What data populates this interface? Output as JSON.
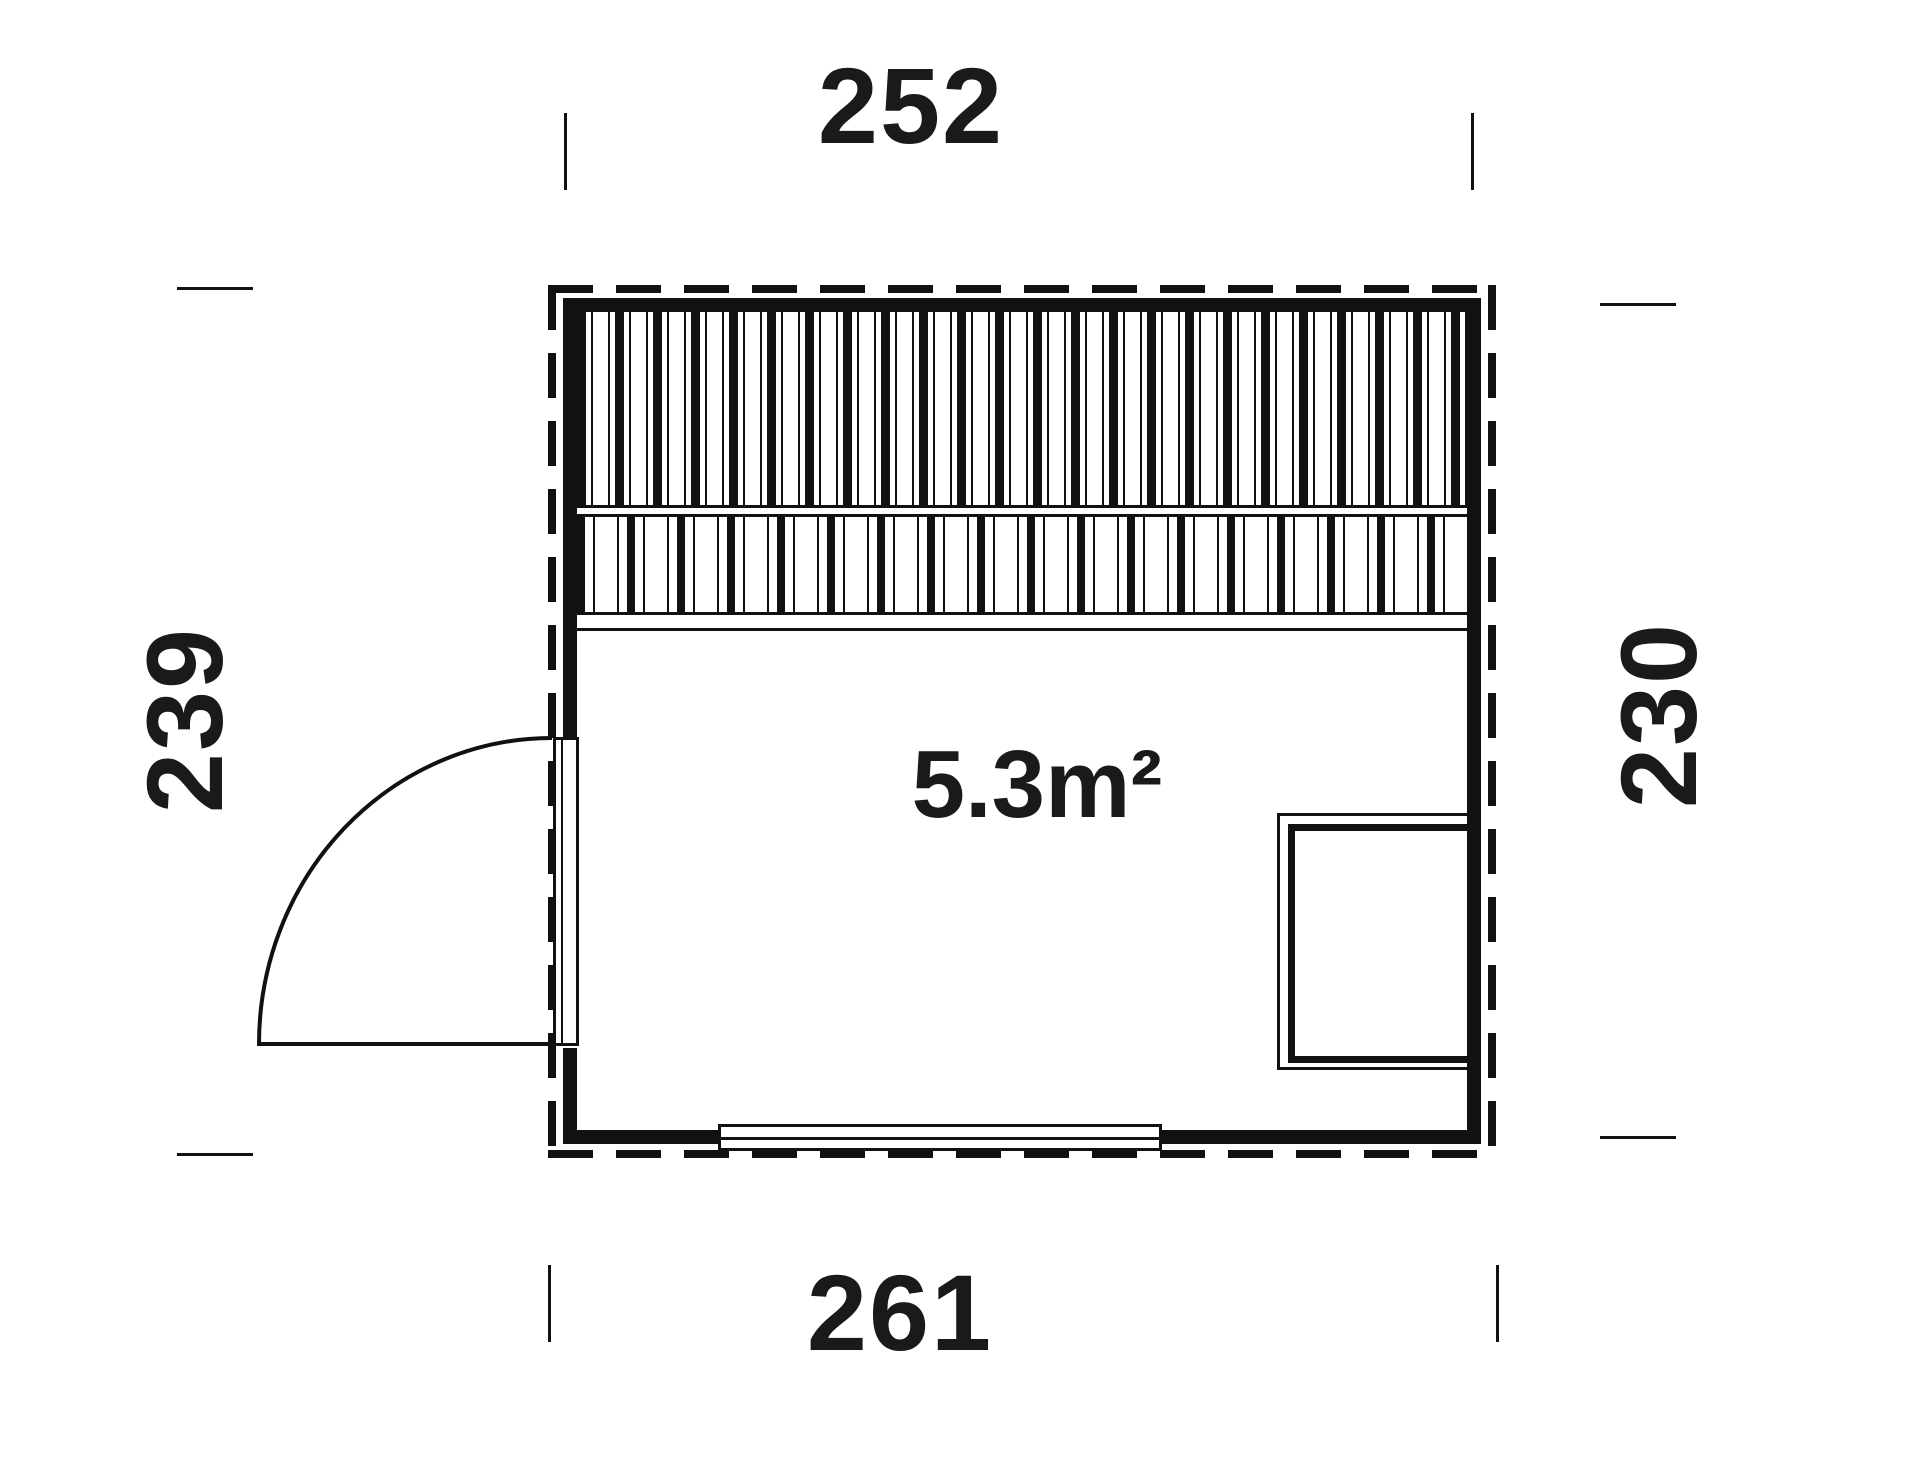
{
  "diagram_type": "floor-plan",
  "area": {
    "label": "5.3m²"
  },
  "dimensions": {
    "top": "252",
    "bottom": "261",
    "left": "239",
    "right": "230"
  },
  "features": {
    "benches": "slatted-bench-area-top",
    "door": "left-wall-door-quarter-swing",
    "window": "bottom-wall-window",
    "heater": "bottom-right-heater"
  },
  "colors": {
    "line": "#111111",
    "background": "#ffffff"
  }
}
